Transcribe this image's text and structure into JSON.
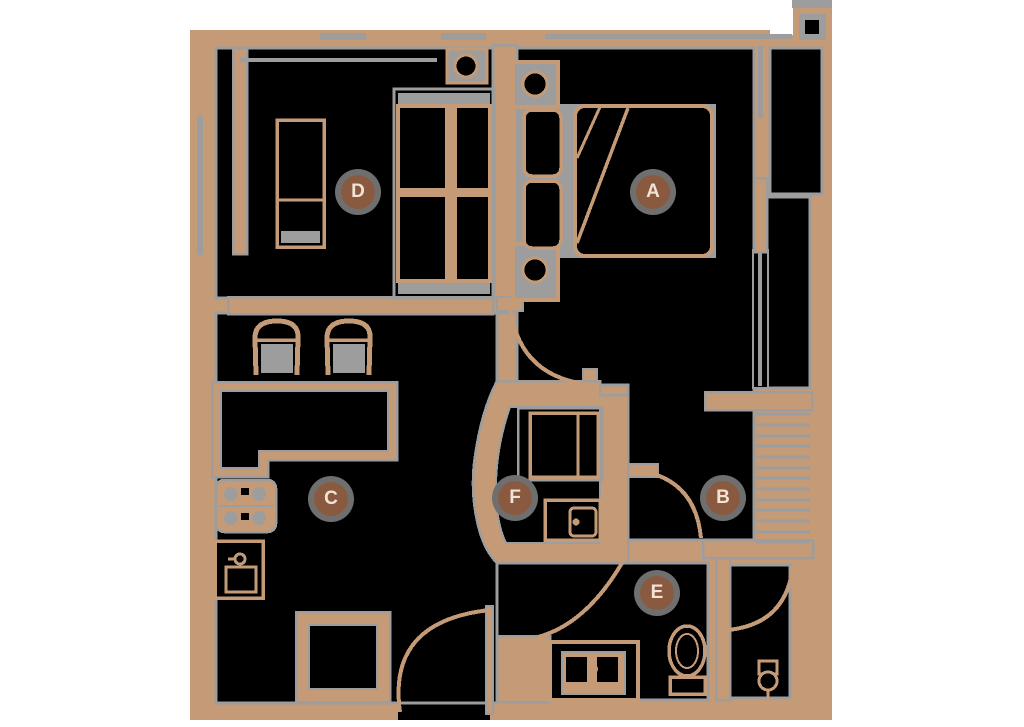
{
  "page": {
    "kind": "apartment floor plan drawing",
    "background": "#ffffff"
  },
  "palette": {
    "wall_tan": "#c59b77",
    "line_gray": "#9d9d9d",
    "floor_black": "#000000",
    "label_brown": "#8a5a40",
    "label_halo_gray": "#6f6f6f",
    "label_text": "#f2e3d5",
    "page_bg": "#ffffff"
  },
  "floor_plan": {
    "room_labels": [
      {
        "letter": "A",
        "x": 653,
        "y": 192
      },
      {
        "letter": "B",
        "x": 723,
        "y": 498
      },
      {
        "letter": "C",
        "x": 331,
        "y": 499
      },
      {
        "letter": "D",
        "x": 358,
        "y": 192
      },
      {
        "letter": "E",
        "x": 657,
        "y": 593
      },
      {
        "letter": "F",
        "x": 515,
        "y": 498
      }
    ]
  }
}
